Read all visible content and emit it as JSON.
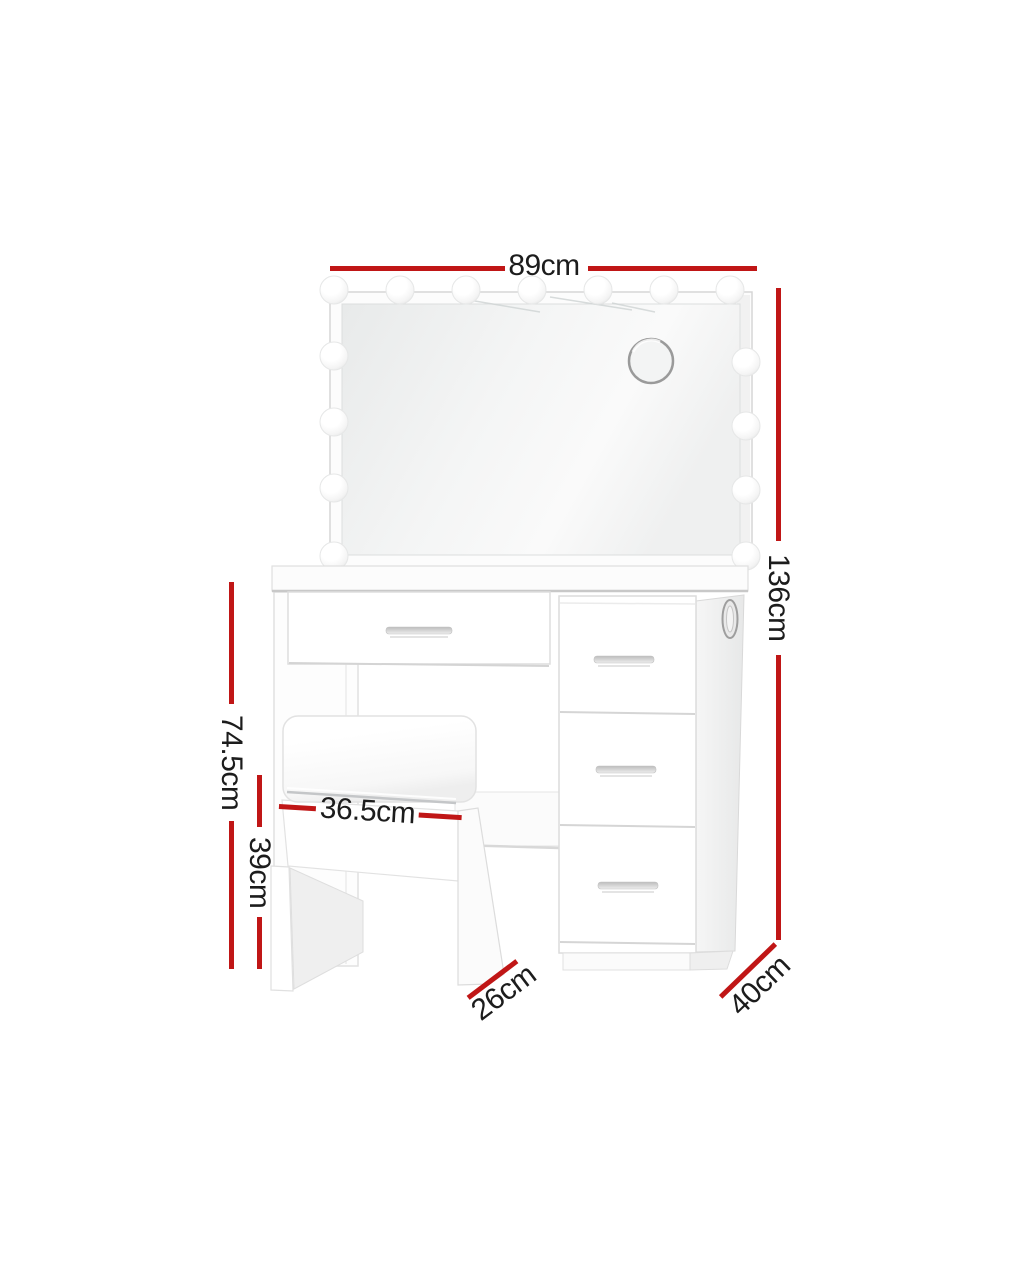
{
  "diagram": {
    "type": "product-dimension-diagram",
    "colors": {
      "dimension_line": "#c01616",
      "dimension_text": "#1c1c1c",
      "furniture_outline": "#dcdcdc",
      "background": "#ffffff"
    },
    "annotations": {
      "overall_width": {
        "label": "89cm"
      },
      "overall_height": {
        "label": "136cm"
      },
      "table_height": {
        "label": "74.5cm"
      },
      "stool_height": {
        "label": "39cm"
      },
      "stool_width": {
        "label": "36.5cm"
      },
      "stool_depth": {
        "label": "26cm"
      },
      "table_depth": {
        "label": "40cm"
      }
    }
  }
}
